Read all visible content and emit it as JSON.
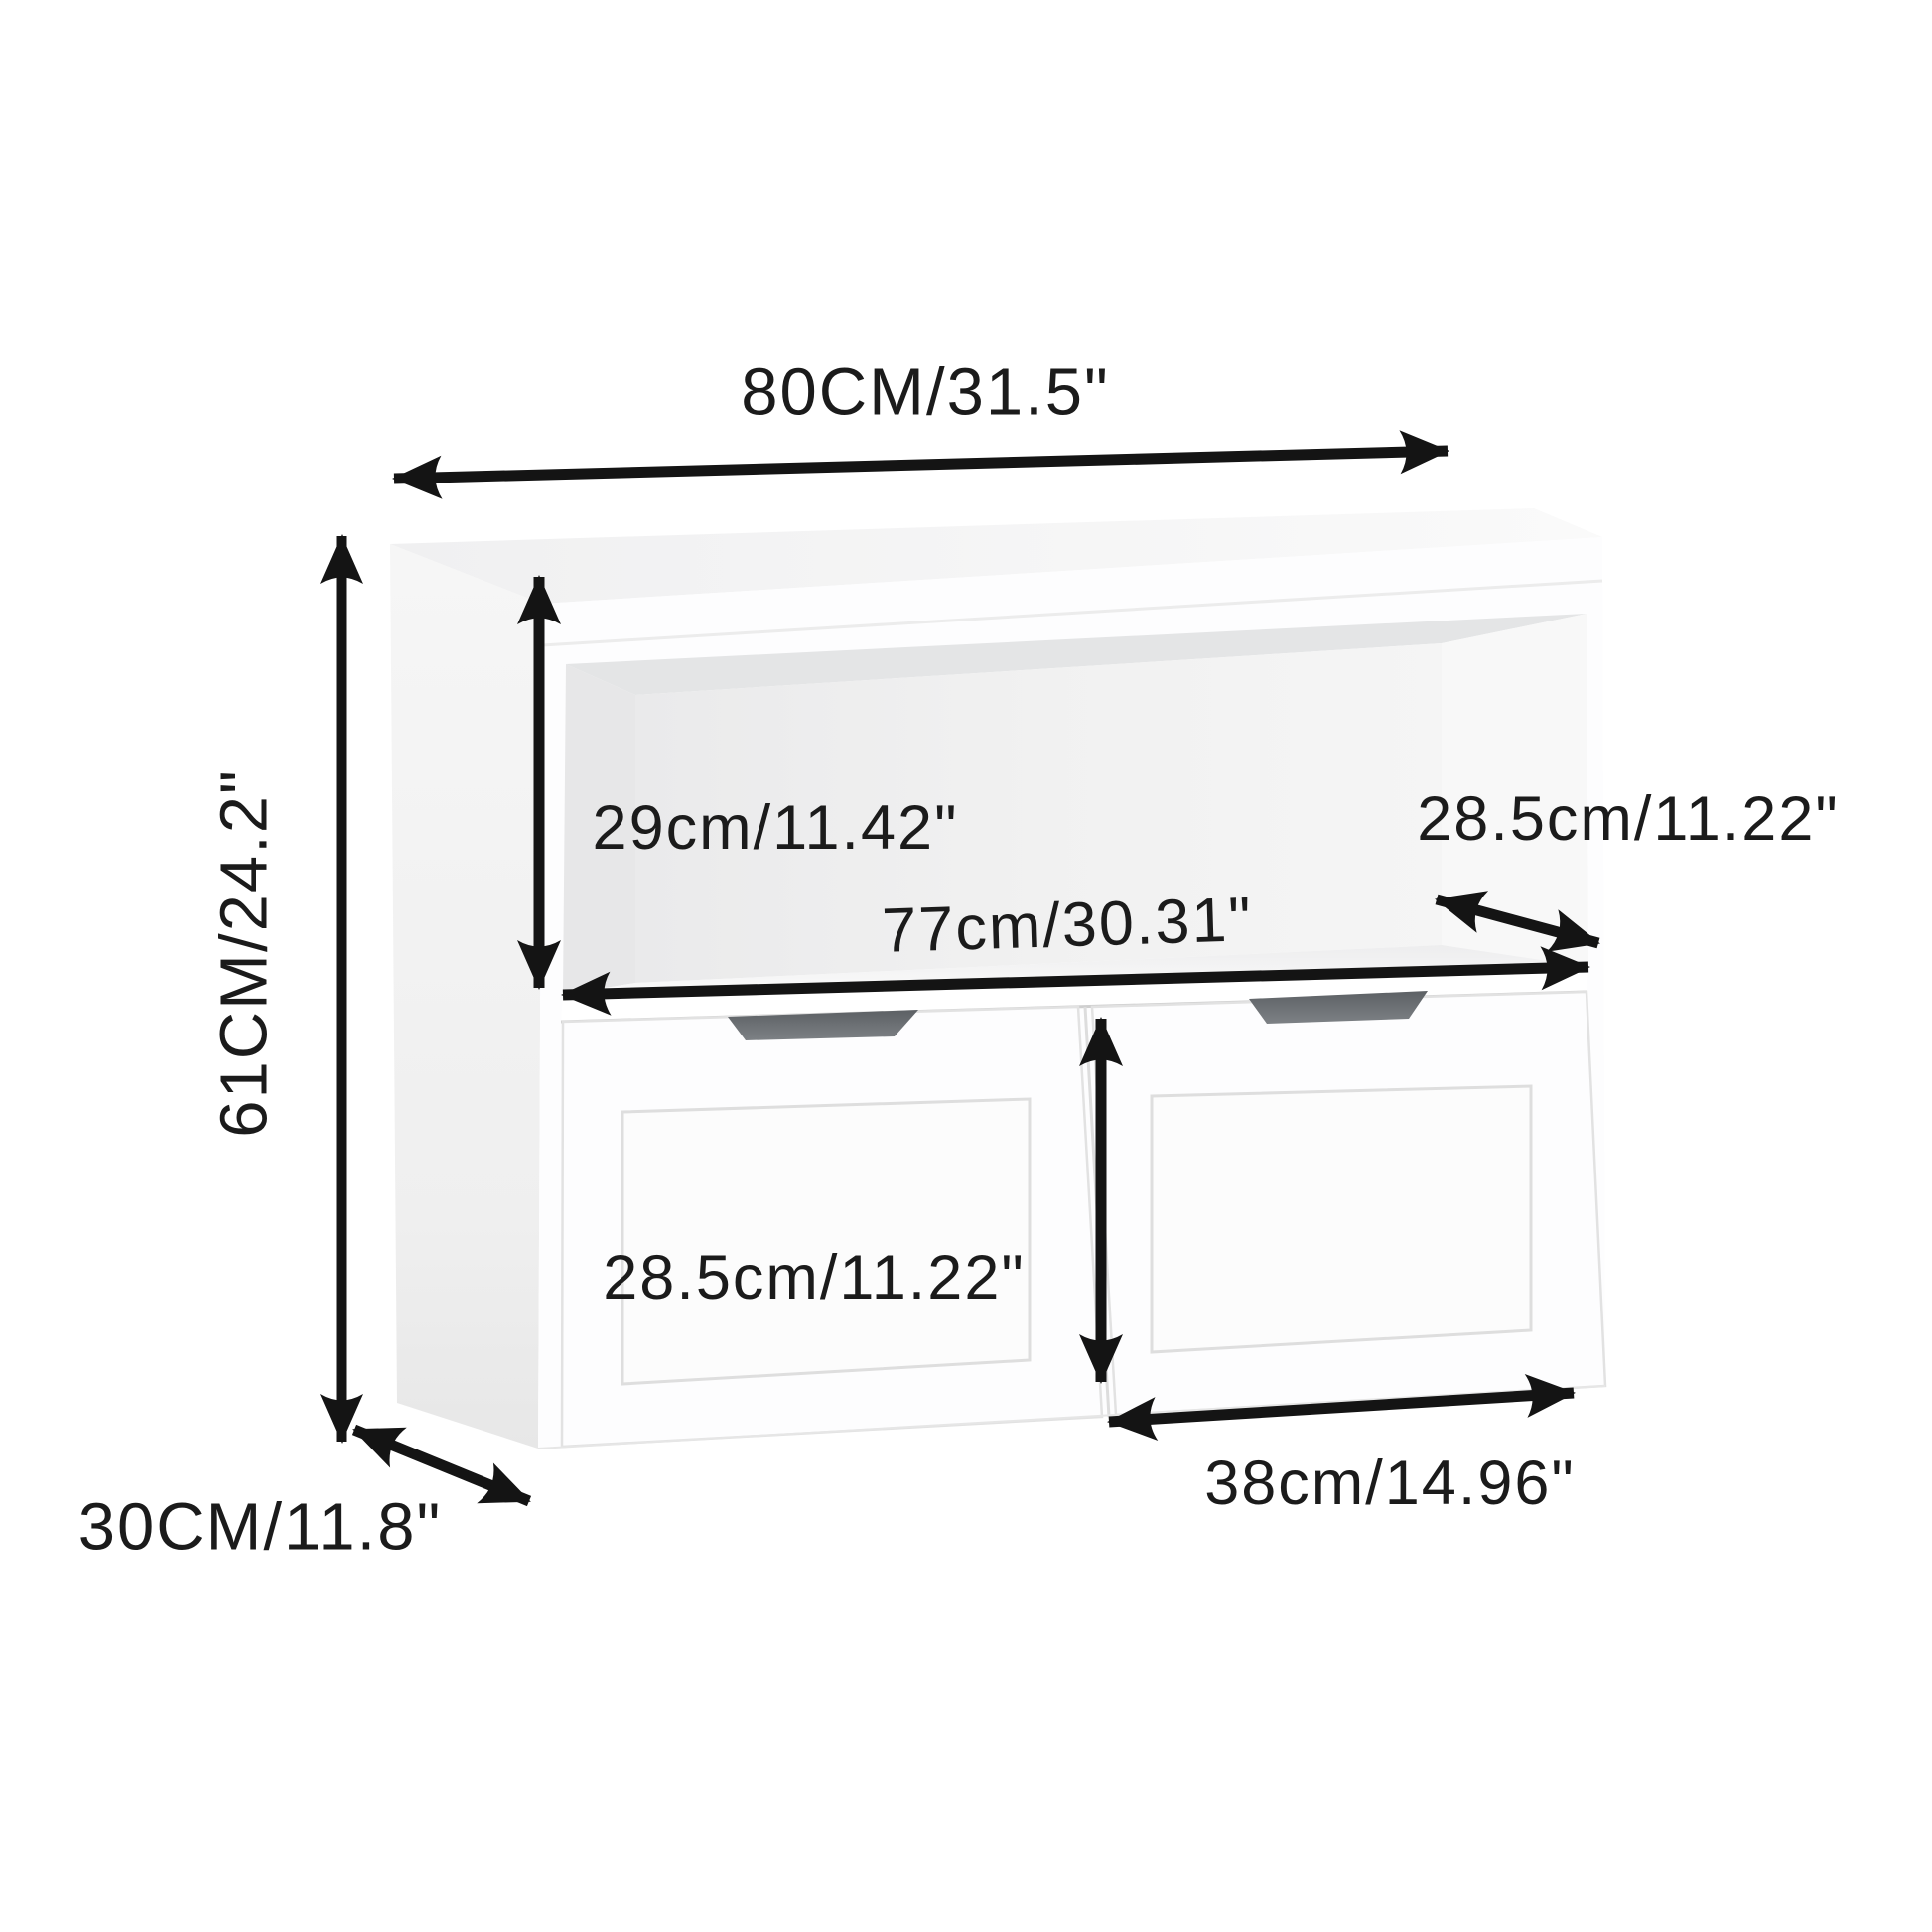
{
  "figure": {
    "title": "Storage cabinet dimension diagram",
    "background_color": "#ffffff",
    "arrow_color": "#141414",
    "text_color": "#1b1b1b",
    "cabinet_color": "#fdfdfe",
    "handle_recess_color": "#63676b"
  },
  "dimensions": {
    "overall_width": {
      "name": "overall width",
      "label": "80CM/31.5\"",
      "cm": 80,
      "inch": 31.5
    },
    "overall_height": {
      "name": "overall height",
      "label": "61CM/24.2\"",
      "cm": 61,
      "inch": 24.2
    },
    "overall_depth": {
      "name": "overall depth",
      "label": "30CM/11.8\"",
      "cm": 30,
      "inch": 11.8
    },
    "shelf_height": {
      "name": "open shelf interior height",
      "label": "29cm/11.42\"",
      "cm": 29,
      "inch": 11.42
    },
    "shelf_depth": {
      "name": "shelf interior depth",
      "label": "28.5cm/11.22\"",
      "cm": 28.5,
      "inch": 11.22
    },
    "inner_width": {
      "name": "interior shelf width",
      "label": "77cm/30.31\"",
      "cm": 77,
      "inch": 30.31
    },
    "drawer_height": {
      "name": "drawer height",
      "label": "28.5cm/11.22\"",
      "cm": 28.5,
      "inch": 11.22
    },
    "drawer_width": {
      "name": "drawer width",
      "label": "38cm/14.96\"",
      "cm": 38,
      "inch": 14.96
    }
  }
}
